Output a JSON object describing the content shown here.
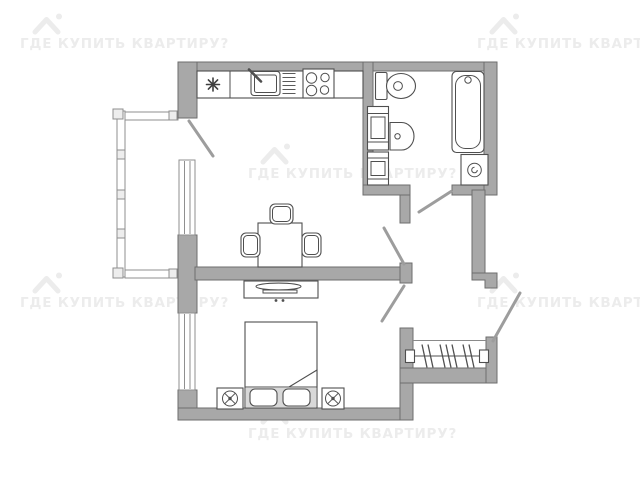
{
  "watermark": {
    "text": "ГДЕ КУПИТЬ КВАРТИРУ?",
    "icon": "house-roof-icon",
    "visible_instances": 6
  },
  "colors": {
    "background": "#ffffff",
    "wall_fill": "#a8a8a8",
    "wall_stroke": "#6e6e6e",
    "furniture_line": "#4f4f4f",
    "door_swing": "#9d9d9d",
    "railing": "#8f8f8f",
    "watermark_text": "#ececec"
  },
  "floor_plan": {
    "type": "one-bedroom-apartment-layout",
    "fixtures": [
      "balcony-railing",
      "balcony-door",
      "kitchen-window",
      "kitchen-counter",
      "asterisk-symbol",
      "kitchen-sink",
      "dish-rack",
      "stove-4-burner",
      "dining-table",
      "chairs-x3",
      "bathroom-door",
      "toilet",
      "shelving-cabinets",
      "washbasin",
      "bathtub",
      "washing-machine",
      "living-room-door",
      "bedroom-door",
      "tv-stand",
      "bed-with-pillows",
      "nightstand-lamps-x2",
      "bedroom-window",
      "wardrobe-with-hangers",
      "entrance-door"
    ]
  }
}
